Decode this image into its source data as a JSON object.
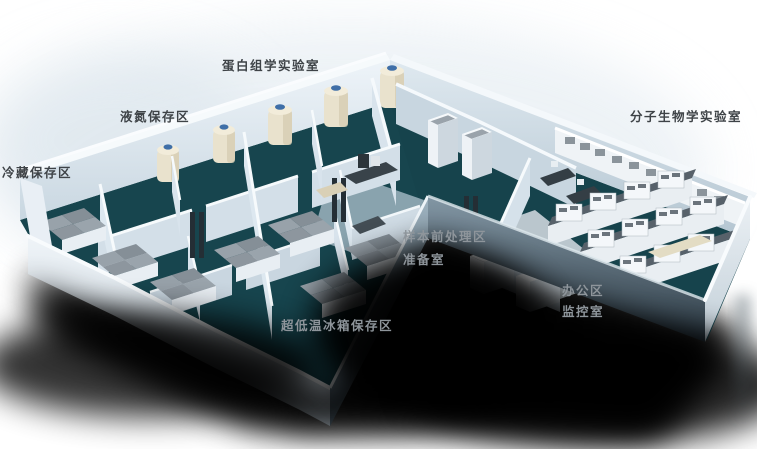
{
  "scene": {
    "type": "3d-isometric-lab-floorplan",
    "colors": {
      "background": "#ffffff",
      "floor_teal": "#17454e",
      "wall_light": "#e9f0f6",
      "wall_mid": "#c9d7e1",
      "wall_shaded": "#8ea3b0",
      "shadow": "#000000",
      "tank_body": "#e9e2cd",
      "tank_cap": "#3f6fa8",
      "bench_top": "#57616a",
      "label_on_light": "#3e4347",
      "label_on_dark": "#8e959b"
    }
  },
  "labels": [
    {
      "id": "proteomics-lab",
      "text": "蛋白组学实验室",
      "tone": "dark"
    },
    {
      "id": "liquid-nitrogen-storage",
      "text": "液氮保存区",
      "tone": "dark"
    },
    {
      "id": "cold-storage",
      "text": "冷藏保存区",
      "tone": "dark"
    },
    {
      "id": "molecular-biology-lab",
      "text": "分子生物学实验室",
      "tone": "dark"
    },
    {
      "id": "sample-pretreatment",
      "text": "样本前处理区",
      "tone": "light"
    },
    {
      "id": "prep-room",
      "text": "准备室",
      "tone": "light"
    },
    {
      "id": "office-area",
      "text": "办公区",
      "tone": "light"
    },
    {
      "id": "monitoring-room",
      "text": "监控室",
      "tone": "light"
    },
    {
      "id": "ult-freezer-storage",
      "text": "超低温冰箱保存区",
      "tone": "light"
    }
  ]
}
